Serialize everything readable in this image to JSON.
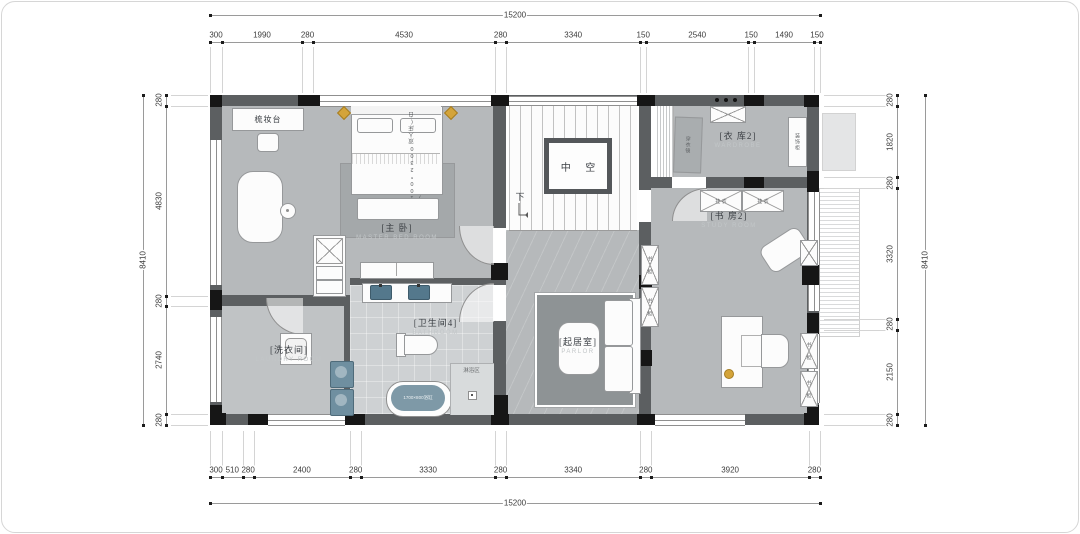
{
  "drawing": {
    "type": "second-floor residential plan"
  },
  "dimensions": {
    "top": {
      "overall": "15200",
      "segments": [
        "300",
        "1990",
        "280",
        "4530",
        "280",
        "3340",
        "150",
        "2540",
        "150",
        "1490",
        "150"
      ]
    },
    "bottom": {
      "overall": "15200",
      "segments": [
        "300",
        "510",
        "280",
        "2400",
        "280",
        "3330",
        "280",
        "3340",
        "280",
        "3920",
        "280"
      ]
    },
    "left": {
      "overall": "8410",
      "segments": [
        "280",
        "4830",
        "280",
        "2740",
        "280"
      ]
    },
    "right": {
      "overall": "8410",
      "segments": [
        "280",
        "1820",
        "280",
        "3320",
        "280",
        "2150",
        "280"
      ]
    }
  },
  "rooms": {
    "master_bedroom": {
      "name": "[主 卧]",
      "name_en": "MASTER BED ROOM"
    },
    "wardrobe2": {
      "name": "[衣 库2]",
      "name_en": "WARDROBE"
    },
    "study2": {
      "name": "[书 房2]",
      "name_en": "STUDY ROOM"
    },
    "parlor": {
      "name": "[起居室]",
      "name_en": "PARLOR"
    },
    "bathroom4": {
      "name": "[卫生间4]",
      "name_en": "BATHROOM"
    },
    "laundry": {
      "name": "[洗衣间]",
      "name_en": "LAUNDRY ROOM"
    },
    "void": {
      "name": "中 空"
    },
    "shower": {
      "name": "淋浴区"
    },
    "stair_down": {
      "name": "下"
    }
  },
  "annotations": {
    "dressing_table": "梳妆台",
    "bed_spec": "2100*2300双人床(白蜡)",
    "bathtub": "1700×800浴缸",
    "hang_clothes": "挂 衣",
    "bookcase": "书 柜",
    "mirror": "穿衣镜",
    "side_cabinet": "装饰柜"
  },
  "colors": {
    "room_gray": "#b6b9bb",
    "bath_tile": "#ced1d3",
    "laundry_gray": "#c0c3c5",
    "rug_dark": "#8e9395",
    "wall_dark": "#5c5f61",
    "column_black": "#161616",
    "fixture_blue": "#54788c",
    "tub_blue": "#7e99a7",
    "accent_gold": "#d4a43a"
  }
}
